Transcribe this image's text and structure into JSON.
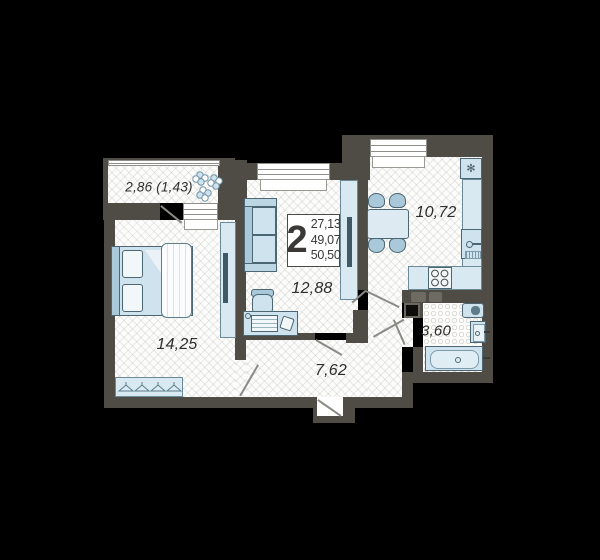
{
  "plan": {
    "type": "apartment-floor-plan",
    "summary": {
      "rooms": "2",
      "line1": "27,13",
      "line2": "49,07",
      "line3": "50,50"
    },
    "labels": {
      "balcony": "2,86 (1,43)",
      "bedroom": "14,25",
      "living": "12,88",
      "hallway": "7,62",
      "kitchen": "10,72",
      "bathroom": "3,60"
    },
    "icons": {
      "fridge": "✻"
    },
    "colors": {
      "background": "#000000",
      "wall": "#4f4c45",
      "floor": "#fcfcfb",
      "furniture": "#cfe3ee",
      "furniture_dark": "#a9c9da",
      "outline": "#4d6673",
      "text": "#2f2e2b"
    }
  }
}
